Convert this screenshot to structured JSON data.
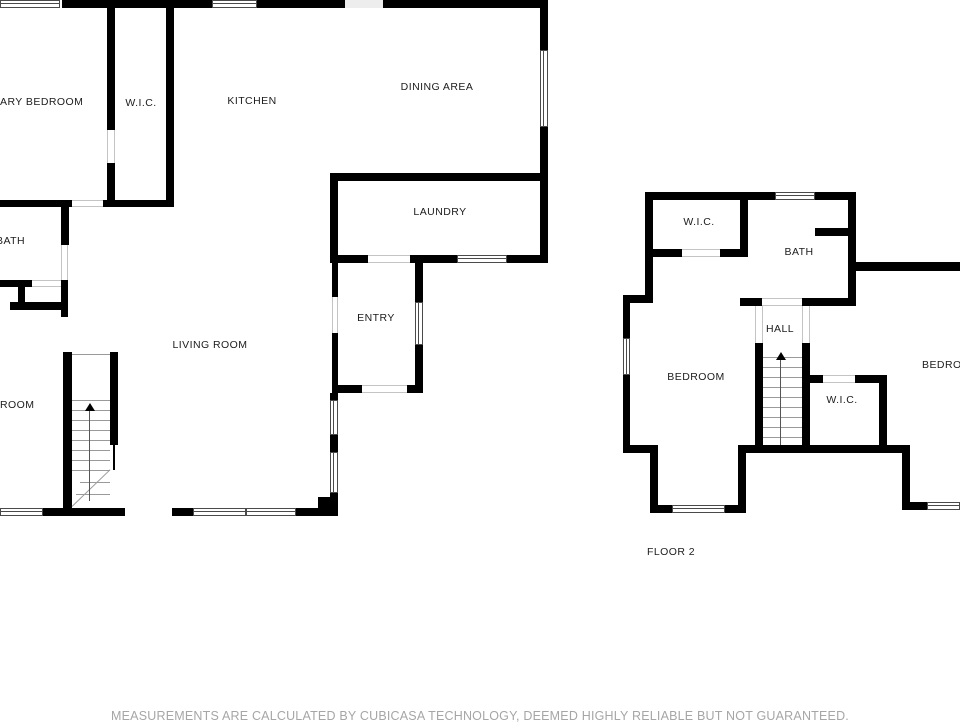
{
  "disclaimer": "MEASUREMENTS ARE CALCULATED BY CUBICASA TECHNOLOGY, DEEMED HIGHLY RELIABLE BUT NOT GUARANTEED.",
  "colors": {
    "wall": "#000000",
    "window_frame": "#4a4a4a",
    "door_opening": "#c4c4c4",
    "stair_tread": "#9a9a9a",
    "room_label": "#1c1c1c",
    "disclaimer_text": "#a6a6a6",
    "background": "#ffffff"
  },
  "floors": [
    {
      "id": "floor-1",
      "rooms": [
        {
          "label": "ARY BEDROOM",
          "name": "room-label-primary-bedroom",
          "x": 0,
          "y": 96,
          "anchor": "left"
        },
        {
          "label": "W.I.C.",
          "name": "room-label-wic",
          "x": 141,
          "y": 97,
          "anchor": "center"
        },
        {
          "label": "KITCHEN",
          "name": "room-label-kitchen",
          "x": 252,
          "y": 95,
          "anchor": "center"
        },
        {
          "label": "DINING AREA",
          "name": "room-label-dining-area",
          "x": 437,
          "y": 81,
          "anchor": "center"
        },
        {
          "label": "LAUNDRY",
          "name": "room-label-laundry",
          "x": 440,
          "y": 206,
          "anchor": "center"
        },
        {
          "label": "BATH",
          "name": "room-label-bath",
          "x": -4,
          "y": 235,
          "anchor": "left"
        },
        {
          "label": "ENTRY",
          "name": "room-label-entry",
          "x": 376,
          "y": 312,
          "anchor": "center"
        },
        {
          "label": "LIVING ROOM",
          "name": "room-label-living-room",
          "x": 210,
          "y": 339,
          "anchor": "center"
        },
        {
          "label": "ROOM",
          "name": "room-label-bedroom-partial",
          "x": 0,
          "y": 399,
          "anchor": "left"
        }
      ],
      "walls": [
        [
          62,
          0,
          150,
          8
        ],
        [
          257,
          0,
          88,
          8
        ],
        [
          383,
          0,
          157,
          8
        ],
        [
          540,
          0,
          8,
          50
        ],
        [
          540,
          127,
          8,
          136
        ],
        [
          107,
          8,
          8,
          122
        ],
        [
          107,
          163,
          8,
          44
        ],
        [
          166,
          8,
          8,
          199
        ],
        [
          0,
          200,
          72,
          7
        ],
        [
          103,
          200,
          71,
          7
        ],
        [
          330,
          173,
          218,
          8
        ],
        [
          330,
          181,
          8,
          82
        ],
        [
          330,
          255,
          38,
          8
        ],
        [
          410,
          255,
          47,
          8
        ],
        [
          507,
          255,
          41,
          8
        ],
        [
          332,
          263,
          6,
          34
        ],
        [
          332,
          333,
          6,
          60
        ],
        [
          415,
          263,
          8,
          39
        ],
        [
          415,
          345,
          8,
          48
        ],
        [
          332,
          385,
          30,
          8
        ],
        [
          407,
          385,
          16,
          8
        ],
        [
          330,
          393,
          8,
          7
        ],
        [
          330,
          435,
          8,
          17
        ],
        [
          330,
          493,
          8,
          23
        ],
        [
          318,
          497,
          20,
          19
        ],
        [
          43,
          508,
          82,
          8
        ],
        [
          172,
          508,
          21,
          8
        ],
        [
          296,
          508,
          42,
          8
        ],
        [
          61,
          207,
          8,
          38
        ],
        [
          61,
          280,
          7,
          37
        ],
        [
          0,
          280,
          32,
          7
        ],
        [
          18,
          287,
          7,
          15
        ],
        [
          10,
          302,
          55,
          8
        ],
        [
          63,
          352,
          9,
          164
        ],
        [
          110,
          352,
          8,
          93
        ],
        [
          113,
          445,
          2,
          25
        ]
      ],
      "gaps": [
        [
          345,
          0,
          38,
          8
        ]
      ],
      "windows": [
        [
          0,
          0,
          60,
          8
        ],
        [
          212,
          0,
          45,
          8
        ],
        [
          540,
          50,
          8,
          77
        ],
        [
          457,
          255,
          50,
          8
        ],
        [
          415,
          302,
          8,
          43
        ],
        [
          330,
          400,
          8,
          35
        ],
        [
          330,
          452,
          8,
          41
        ],
        [
          0,
          508,
          43,
          8
        ],
        [
          193,
          508,
          53,
          8
        ],
        [
          246,
          508,
          50,
          8
        ]
      ],
      "openings": [
        [
          72,
          200,
          31,
          7
        ],
        [
          107,
          130,
          8,
          33
        ],
        [
          61,
          245,
          7,
          35
        ],
        [
          32,
          280,
          29,
          7
        ],
        [
          368,
          255,
          42,
          8
        ],
        [
          362,
          385,
          45,
          8
        ],
        [
          332,
          297,
          6,
          36
        ]
      ],
      "lines": [
        [
          72,
          354,
          38,
          1
        ],
        [
          72,
          400,
          38,
          1
        ],
        [
          72,
          410,
          38,
          1
        ],
        [
          72,
          420,
          38,
          1
        ],
        [
          72,
          430,
          38,
          1
        ],
        [
          72,
          440,
          38,
          1
        ],
        [
          72,
          450,
          38,
          1
        ],
        [
          72,
          460,
          38,
          1
        ],
        [
          72,
          470,
          38,
          1
        ],
        [
          72,
          506,
          53,
          1,
          -44
        ],
        [
          80,
          482,
          30,
          1
        ],
        [
          76,
          494,
          34,
          1
        ]
      ],
      "arrows": [
        {
          "head": [
            90,
            403
          ],
          "shaft": [
            89,
            411,
            90
          ]
        }
      ]
    },
    {
      "id": "floor-2",
      "rooms": [
        {
          "label": "W.I.C.",
          "name": "room-label-wic-2",
          "x": 699,
          "y": 216,
          "anchor": "center"
        },
        {
          "label": "BATH",
          "name": "room-label-bath-2",
          "x": 799,
          "y": 246,
          "anchor": "center"
        },
        {
          "label": "HALL",
          "name": "room-label-hall",
          "x": 780,
          "y": 323,
          "anchor": "center"
        },
        {
          "label": "BEDROOM",
          "name": "room-label-bedroom-left",
          "x": 696,
          "y": 371,
          "anchor": "center"
        },
        {
          "label": "W.I.C.",
          "name": "room-label-wic-3",
          "x": 842,
          "y": 394,
          "anchor": "center"
        },
        {
          "label": "BEDROOM",
          "name": "room-label-bedroom-right",
          "x": 922,
          "y": 359,
          "anchor": "left"
        },
        {
          "label": "FLOOR 2",
          "name": "floor-label",
          "x": 671,
          "y": 546,
          "anchor": "center"
        }
      ],
      "walls": [
        [
          645,
          192,
          130,
          8
        ],
        [
          815,
          192,
          41,
          8
        ],
        [
          645,
          192,
          8,
          111
        ],
        [
          740,
          192,
          8,
          65
        ],
        [
          848,
          192,
          8,
          111
        ],
        [
          815,
          228,
          33,
          8
        ],
        [
          856,
          262,
          104,
          9
        ],
        [
          653,
          249,
          29,
          8
        ],
        [
          720,
          249,
          28,
          8
        ],
        [
          740,
          298,
          22,
          8
        ],
        [
          802,
          298,
          54,
          8
        ],
        [
          623,
          295,
          30,
          8
        ],
        [
          623,
          303,
          7,
          37
        ],
        [
          623,
          375,
          7,
          78
        ],
        [
          755,
          343,
          8,
          102
        ],
        [
          802,
          343,
          8,
          102
        ],
        [
          738,
          445,
          172,
          8
        ],
        [
          623,
          445,
          34,
          8
        ],
        [
          650,
          445,
          8,
          68
        ],
        [
          738,
          453,
          8,
          60
        ],
        [
          658,
          505,
          14,
          8
        ],
        [
          725,
          505,
          21,
          8
        ],
        [
          810,
          375,
          13,
          8
        ],
        [
          855,
          375,
          32,
          8
        ],
        [
          879,
          375,
          8,
          78
        ],
        [
          902,
          445,
          8,
          65
        ],
        [
          910,
          502,
          17,
          8
        ]
      ],
      "gaps": [],
      "windows": [
        [
          775,
          192,
          40,
          8
        ],
        [
          623,
          338,
          7,
          37
        ],
        [
          672,
          505,
          53,
          8
        ],
        [
          927,
          502,
          33,
          8
        ]
      ],
      "openings": [
        [
          682,
          249,
          38,
          8
        ],
        [
          762,
          298,
          40,
          8
        ],
        [
          823,
          375,
          32,
          8
        ],
        [
          755,
          306,
          8,
          37
        ],
        [
          802,
          306,
          8,
          37
        ]
      ],
      "lines": [
        [
          763,
          357,
          39,
          1
        ],
        [
          763,
          367,
          39,
          1
        ],
        [
          763,
          377,
          39,
          1
        ],
        [
          763,
          387,
          39,
          1
        ],
        [
          763,
          397,
          39,
          1
        ],
        [
          763,
          407,
          39,
          1
        ],
        [
          763,
          417,
          39,
          1
        ],
        [
          763,
          427,
          39,
          1
        ],
        [
          763,
          437,
          39,
          1
        ]
      ],
      "arrows": [
        {
          "head": [
            781,
            352
          ],
          "shaft": [
            780,
            360,
            85
          ]
        }
      ]
    }
  ]
}
